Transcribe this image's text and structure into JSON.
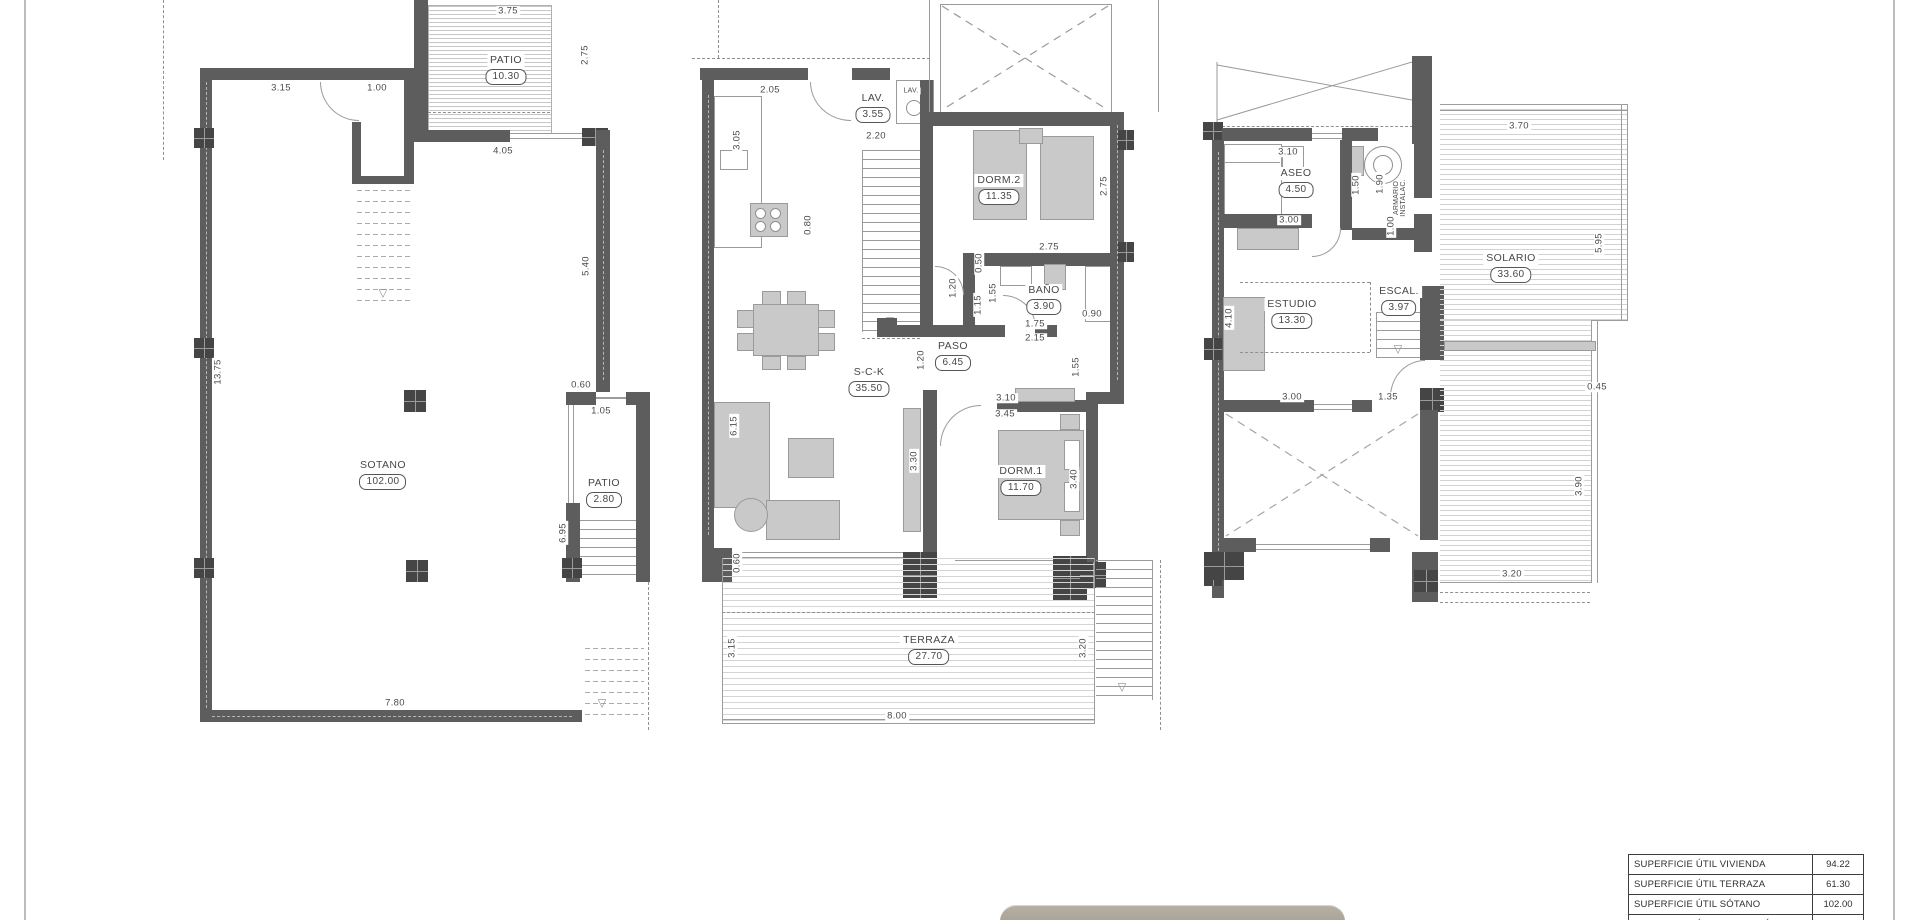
{
  "rooms": {
    "sotano": {
      "name": "SOTANO",
      "area": "102.00"
    },
    "patio1": {
      "name": "PATIO",
      "area": "10.30"
    },
    "patio2": {
      "name": "PATIO",
      "area": "2.80"
    },
    "lav": {
      "name": "LAV.",
      "area": "3.55"
    },
    "lav_small": {
      "name": "LAV."
    },
    "dorm2": {
      "name": "DORM.2",
      "area": "11.35"
    },
    "bano": {
      "name": "BAÑO",
      "area": "3.90"
    },
    "paso": {
      "name": "PASO",
      "area": "6.45"
    },
    "sck": {
      "name": "S-C-K",
      "area": "35.50"
    },
    "dorm1": {
      "name": "DORM.1",
      "area": "11.70"
    },
    "terraza": {
      "name": "TERRAZA",
      "area": "27.70"
    },
    "aseo": {
      "name": "ASEO",
      "area": "4.50"
    },
    "armario": {
      "line1": "ARMARIO",
      "line2": "INSTALAC."
    },
    "estudio": {
      "name": "ESTUDIO",
      "area": "13.30"
    },
    "escal": {
      "name": "ESCAL.",
      "area": "3.97"
    },
    "solario": {
      "name": "SOLARIO",
      "area": "33.60"
    }
  },
  "dims": {
    "s1": "3.75",
    "s2": "2.75",
    "s3": "3.15",
    "s4": "1.00",
    "s5": "4.05",
    "s6": "5.40",
    "s7": "13.75",
    "s8": "0.60",
    "s9": "1.05",
    "s10": "6.95",
    "s11": "7.80",
    "m1": "2.05",
    "m2": "2.20",
    "m3": "3.05",
    "m4": "0.80",
    "m5": "2.75",
    "m6": "2.75",
    "m7": "0.50",
    "m8": "1.20",
    "m9": "1.15",
    "m10": "1.55",
    "m11": "0.90",
    "m12": "1.75",
    "m13": "2.15",
    "m14": "1.55",
    "m15": "1.20",
    "m16": "3.10",
    "m17": "3.45",
    "m18": "3.40",
    "m19": "3.30",
    "m20": "6.15",
    "m21": "0.60",
    "m22": "3.15",
    "m23": "3.20",
    "m24": "8.00",
    "r1": "3.10",
    "r2": "1.50",
    "r3": "1.90",
    "r4": "1.00",
    "r5": "3.00",
    "r6": "3.70",
    "r7": "5.95",
    "r8": "4.10",
    "r9": "3.00",
    "r10": "1.35",
    "r11": "0.45",
    "r12": "3.90",
    "r13": "3.20"
  },
  "icons": {
    "stair_arrow": "▽"
  },
  "table": {
    "rows": [
      {
        "label": "SUPERFICIE ÚTIL VIVIENDA",
        "value": "94.22"
      },
      {
        "label": "SUPERFICIE ÚTIL TERRAZA",
        "value": "61.30"
      },
      {
        "label": "SUPERFICIE ÚTIL SÓTANO",
        "value": "102.00"
      },
      {
        "label": "SUPERFICIE ÚTIL PATIOS SÓTANO",
        "value": "13.10"
      }
    ]
  }
}
